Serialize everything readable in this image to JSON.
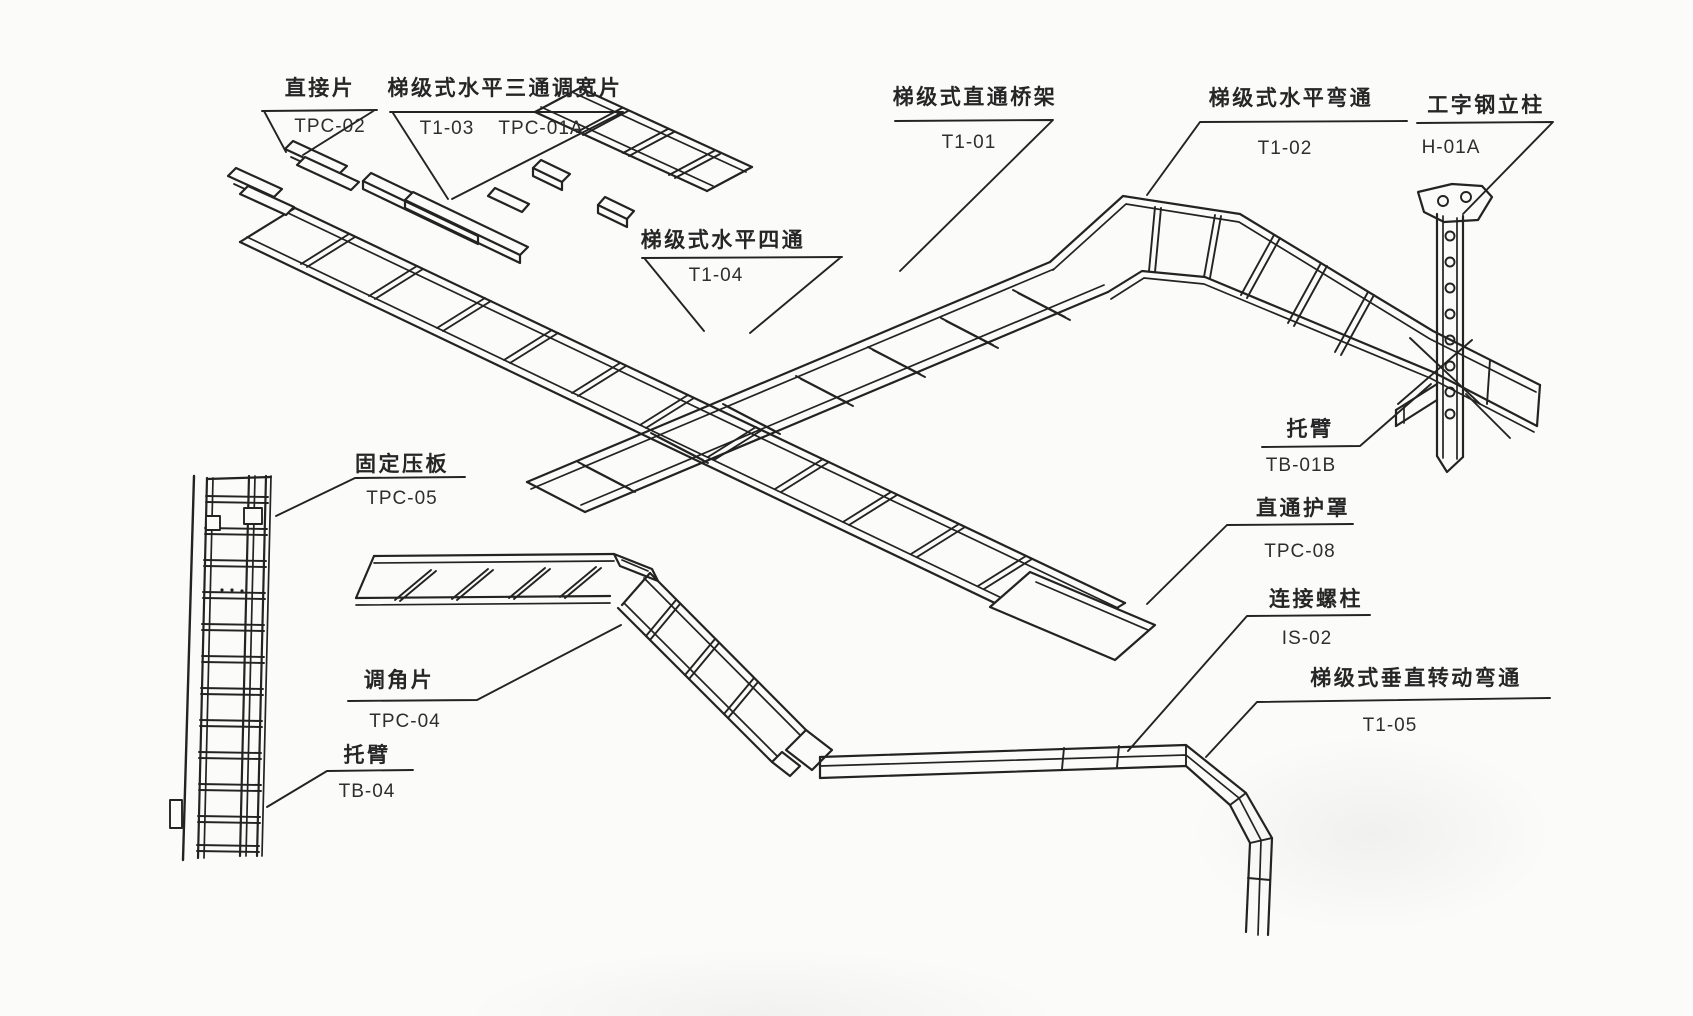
{
  "colors": {
    "line": "#232323",
    "paper": "#fbfbfa",
    "text": "#262626"
  },
  "callouts": {
    "connector_strip": {
      "label": "直接片",
      "code": "TPC-02"
    },
    "tee_widener": {
      "label": "梯级式水平三通调宽片",
      "codes": [
        "T1-03",
        "TPC-01A"
      ]
    },
    "cross": {
      "label": "梯级式水平四通",
      "code": "T1-04"
    },
    "straight_tray": {
      "label": "梯级式直通桥架",
      "code": "T1-01"
    },
    "horizontal_bend": {
      "label": "梯级式水平弯通",
      "code": "T1-02"
    },
    "steel_column": {
      "label": "工字钢立柱",
      "code": "H-01A"
    },
    "bracket_right": {
      "label": "托臂",
      "code": "TB-01B"
    },
    "cover": {
      "label": "直通护罩",
      "code": "TPC-08"
    },
    "connect_stud": {
      "label": "连接螺柱",
      "code": "IS-02"
    },
    "vertical_bend": {
      "label": "梯级式垂直转动弯通",
      "code": "T1-05"
    },
    "fixing_clamp": {
      "label": "固定压板",
      "code": "TPC-05"
    },
    "angle_piece": {
      "label": "调角片",
      "code": "TPC-04"
    },
    "bracket_left": {
      "label": "托臂",
      "code": "TB-04"
    }
  }
}
